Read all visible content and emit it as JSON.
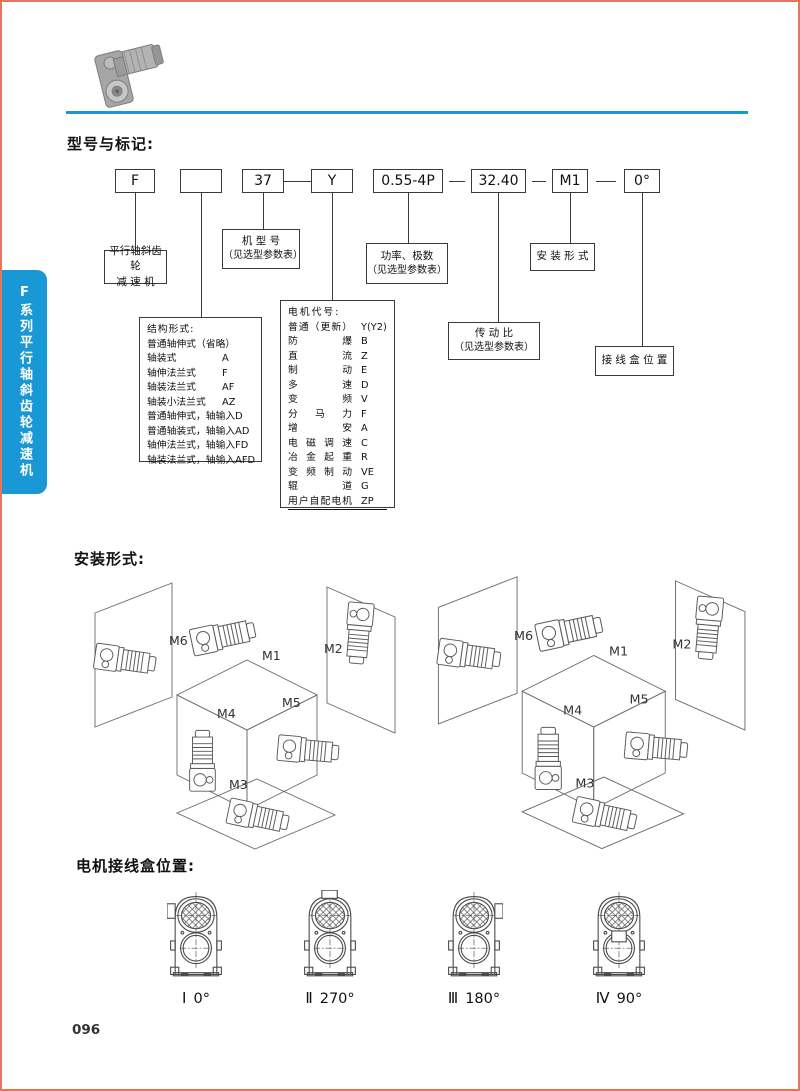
{
  "page": {
    "number": "096"
  },
  "colors": {
    "accent_blue": "#1899d5",
    "page_border": "#e4765c",
    "line": "#3a3a3a"
  },
  "sidebar": {
    "series_label": "F系列平行轴斜齿轮减速机"
  },
  "model_section": {
    "title": "型号与标记:",
    "code_boxes": [
      {
        "text": "F"
      },
      {
        "text": ""
      },
      {
        "text": "37"
      },
      {
        "text": "Y"
      },
      {
        "text": "0.55-4P"
      },
      {
        "text": "32.40"
      },
      {
        "text": "M1"
      },
      {
        "text": "0°"
      }
    ],
    "callouts": {
      "reducer": {
        "line1": "平行轴斜齿轮",
        "line2": "减 速 机"
      },
      "model_no": {
        "line1": "机 型 号",
        "line2": "（见选型参数表）"
      },
      "power": {
        "line1": "功率、极数",
        "line2": "（见选型参数表）"
      },
      "mounting": {
        "line1": "安 装 形 式"
      },
      "ratio": {
        "line1": "传 动 比",
        "line2": "（见选型参数表）"
      },
      "terminal": {
        "line1": "接 线 盒 位 置"
      }
    },
    "structure_box": {
      "title": "结构形式:",
      "items": [
        {
          "name": "普通轴伸式（省略）",
          "code": ""
        },
        {
          "name": "轴装式",
          "code": "A"
        },
        {
          "name": "轴伸法兰式",
          "code": "F"
        },
        {
          "name": "轴装法兰式",
          "code": "AF"
        },
        {
          "name": "轴装小法兰式",
          "code": "AZ"
        },
        {
          "name": "普通轴伸式，轴输入",
          "code": "D"
        },
        {
          "name": "普通轴装式，轴输入",
          "code": "AD"
        },
        {
          "name": "轴伸法兰式，轴输入",
          "code": "FD"
        },
        {
          "name": "轴装法兰式，轴输入",
          "code": "AFD"
        }
      ]
    },
    "motor_box": {
      "title": "电机代号:",
      "items": [
        {
          "name": "普通（更新）",
          "code": "Y(Y2)"
        },
        {
          "name": "防爆",
          "code": "B"
        },
        {
          "name": "直流",
          "code": "Z"
        },
        {
          "name": "制动",
          "code": "E"
        },
        {
          "name": "多速",
          "code": "D"
        },
        {
          "name": "变频",
          "code": "V"
        },
        {
          "name": "分马力",
          "code": "F"
        },
        {
          "name": "增安",
          "code": "A"
        },
        {
          "name": "电磁调速",
          "code": "C"
        },
        {
          "name": "冶金起重",
          "code": "R"
        },
        {
          "name": "变频制动",
          "code": "VE"
        },
        {
          "name": "辊道",
          "code": "G"
        },
        {
          "name": "用户自配电机",
          "code": "ZP"
        }
      ]
    }
  },
  "mounting_section": {
    "title": "安装形式:",
    "position_labels": {
      "m1": "M1",
      "m2": "M2",
      "m3": "M3",
      "m4": "M4",
      "m5": "M5",
      "m6": "M6"
    }
  },
  "terminal_section": {
    "title": "电机接线盒位置:",
    "positions": [
      {
        "numeral": "Ⅰ",
        "angle": "0°",
        "box_side": "left"
      },
      {
        "numeral": "Ⅱ",
        "angle": "270°",
        "box_side": "top"
      },
      {
        "numeral": "Ⅲ",
        "angle": "180°",
        "box_side": "right"
      },
      {
        "numeral": "Ⅳ",
        "angle": "90°",
        "box_side": "bottom"
      }
    ]
  }
}
